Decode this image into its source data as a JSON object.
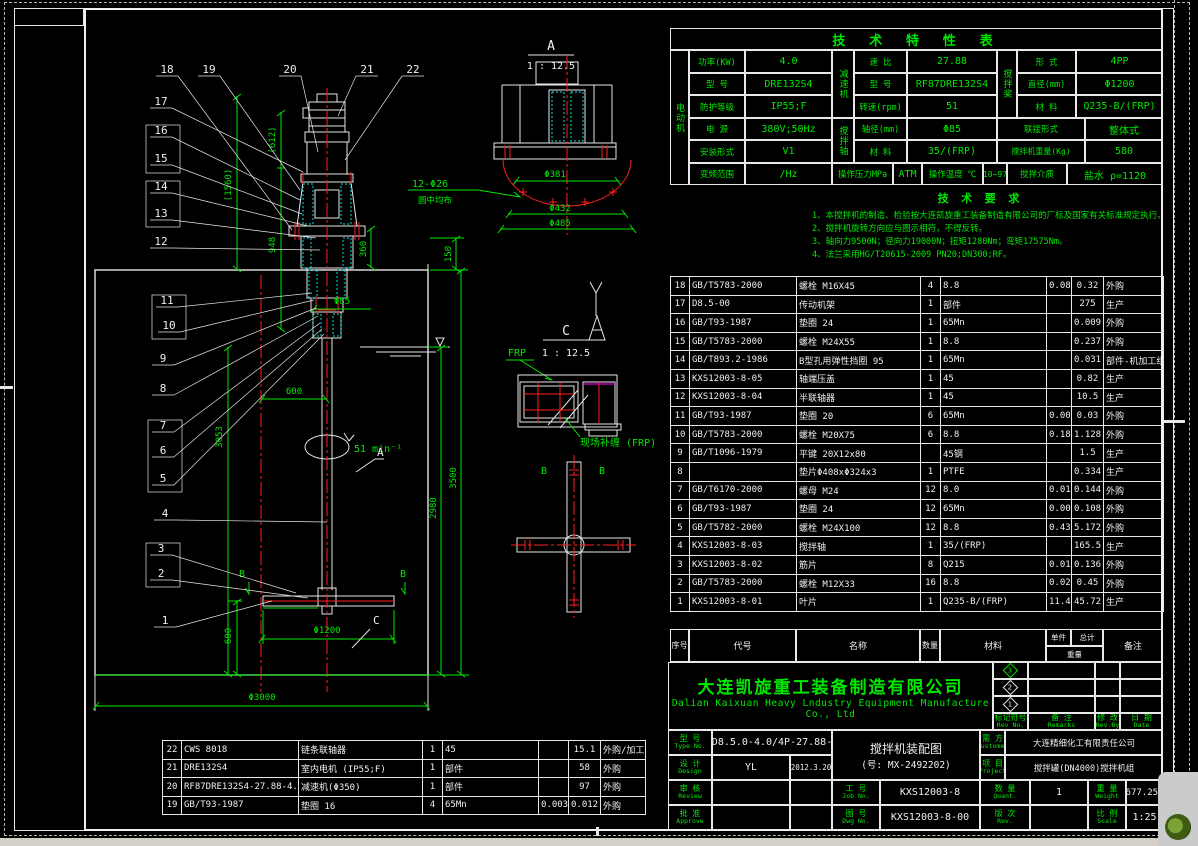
{
  "colors": {
    "green": "#00e800",
    "white": "#f0f0f0",
    "red": "#ff2020",
    "cyan": "#00e0e0",
    "magenta": "#ff00ff"
  },
  "spec_table": {
    "title": "技 术 特 性 表",
    "g_motor": "电动机",
    "g_reducer": "减速机",
    "g_shaft": "搅拌轴",
    "g_impeller": "搅拌桨",
    "r1": [
      "功率(KW)",
      "4.0",
      "速 比",
      "27.88",
      "形 式",
      "4PP"
    ],
    "r2": [
      "型 号",
      "DRE132S4",
      "型 号",
      "RF87DRE132S4",
      "直径(mm)",
      "Φ1200"
    ],
    "r3": [
      "防护等级",
      "IP55;F",
      "转速(rpm)",
      "51",
      "材 料",
      "Q235-B/(FRP)"
    ],
    "r4": [
      "电 源",
      "380V;50Hz",
      "轴径(mm)",
      "Φ85",
      "联接形式",
      "整体式"
    ],
    "r5": [
      "安装形式",
      "V1",
      "材 料",
      "35/(FRP)",
      "搅拌机重量(Kg)",
      "580"
    ],
    "r6": [
      "变频范围",
      "/Hz",
      "操作压力MPa",
      "ATM",
      "操作温度 ℃",
      "10~97",
      "搅拌介质",
      "盐水 ρ=1120"
    ]
  },
  "tech_req": {
    "title": "技 术 要 求",
    "lines": [
      "1、本搅拌机的制造、检验按大连凯旋重工装备制造有限公司的厂标及国家有关标准规定执行。",
      "2、搅拌机旋转方向应与图示相符，不得反转。",
      "3、轴向力9500N；径向力19000N；扭矩1280Nm；弯矩17575Nm。",
      "4、法兰采用HG/T20615-2009 PN20;DN300;RF。"
    ]
  },
  "bom": {
    "headers": {
      "no": "序号",
      "code": "代号",
      "name": "名称",
      "qty": "数量",
      "material": "材料",
      "unit": "单件",
      "total": "总计",
      "weight": "重量",
      "remark": "备注"
    },
    "rows": [
      [
        "18",
        "GB/T5783-2000",
        "螺栓 M16X45",
        "4",
        "8.8",
        "0.08",
        "0.32",
        "外购"
      ],
      [
        "17",
        "D8.5-00",
        "传动机架",
        "1",
        "部件",
        "",
        "275",
        "生产"
      ],
      [
        "16",
        "GB/T93-1987",
        "垫圈 24",
        "1",
        "65Mn",
        "",
        "0.009",
        "外购"
      ],
      [
        "15",
        "GB/T5783-2000",
        "螺栓 M24X55",
        "1",
        "8.8",
        "",
        "0.237",
        "外购"
      ],
      [
        "14",
        "GB/T893.2-1986",
        "B型孔用弹性挡圈 95",
        "1",
        "65Mn",
        "",
        "0.031",
        "部件-机加工组装"
      ],
      [
        "13",
        "KXS12003-8-05",
        "轴端压盖",
        "1",
        "45",
        "",
        "0.82",
        "生产"
      ],
      [
        "12",
        "KXS12003-8-04",
        "半联轴器",
        "1",
        "45",
        "",
        "10.5",
        "生产"
      ],
      [
        "11",
        "GB/T93-1987",
        "垫圈 20",
        "6",
        "65Mn",
        "0.005",
        "0.03",
        "外购"
      ],
      [
        "10",
        "GB/T5783-2000",
        "螺栓 M20X75",
        "6",
        "8.8",
        "0.188",
        "1.128",
        "外购"
      ],
      [
        "9",
        "GB/T1096-1979",
        "平键 20X12x80",
        "",
        "45钢",
        "",
        "1.5",
        "生产"
      ],
      [
        "8",
        "",
        "垫片Φ408xΦ324x3",
        "1",
        "PTFE",
        "",
        "0.334",
        "生产"
      ],
      [
        "7",
        "GB/T6170-2000",
        "螺母 M24",
        "12",
        "8.0",
        "0.012",
        "0.144",
        "外购"
      ],
      [
        "6",
        "GB/T93-1987",
        "垫圈 24",
        "12",
        "65Mn",
        "0.009",
        "0.108",
        "外购"
      ],
      [
        "5",
        "GB/T5782-2000",
        "螺栓 M24X100",
        "12",
        "8.8",
        "0.431",
        "5.172",
        "外购"
      ],
      [
        "4",
        "KXS12003-8-03",
        "搅拌轴",
        "1",
        "35/(FRP)",
        "",
        "165.5",
        "生产"
      ],
      [
        "3",
        "KXS12003-8-02",
        "筋片",
        "8",
        "Q215",
        "0.017",
        "0.136",
        "外购"
      ],
      [
        "2",
        "GB/T5783-2000",
        "螺栓 M12X33",
        "16",
        "8.8",
        "0.028",
        "0.45",
        "外购"
      ],
      [
        "1",
        "KXS12003-8-01",
        "叶片",
        "1",
        "Q235-B/(FRP)",
        "11.43",
        "45.72",
        "生产"
      ]
    ]
  },
  "left_table": {
    "rows": [
      [
        "22",
        "CWS 8018",
        "链条联轴器",
        "1",
        "45",
        "",
        "15.1",
        "外购/加工"
      ],
      [
        "21",
        "DRE132S4",
        "室内电机 (IP55;F)",
        "1",
        "部件",
        "",
        "58",
        "外购"
      ],
      [
        "20",
        "RF87DRE132S4-27.88-4.0Kw",
        "减速机(Φ350)",
        "1",
        "部件",
        "",
        "97",
        "外购"
      ],
      [
        "19",
        "GB/T93-1987",
        "垫圈 16",
        "4",
        "65Mn",
        "0.003",
        "0.012",
        "外购"
      ]
    ]
  },
  "title_block": {
    "company_cn": "大连凯旋重工装备制造有限公司",
    "company_en1": "Dalian Kaixuan Heavy Lndustry Equipment Manufacture",
    "company_en2": "Co., Ltd",
    "diamonds": [
      "3",
      "2",
      "1"
    ],
    "rev_no_cn": "标记符号",
    "rev_no_en": "Rev No.",
    "remarks_cn": "备 注",
    "remarks_en": "Remarks",
    "revby_cn": "修 改",
    "revby_en": "Rev.By",
    "date_cn": "日 期",
    "date_en": "Date",
    "type_cn": "型 号",
    "type_en": "Type No.",
    "type_value": "AD8.5.0-4.0/4P-27.88-P",
    "design_cn": "设 计",
    "design_en": "Design",
    "design_value": "YL",
    "design_date": "2012.3.20",
    "review_cn": "审 核",
    "review_en": "Review",
    "approve_cn": "批 准",
    "approve_en": "Approve",
    "name_line1": "搅拌机装配图",
    "name_line2": "(号: MX-2492202)",
    "customer_cn": "需 方",
    "customer_en": "Customer",
    "customer_value": "大连精细化工有限责任公司",
    "project_cn": "项 目",
    "project_en": "Project",
    "project_value": "搅拌罐(DN4000)搅拌机组",
    "job_cn": "工 号",
    "job_en": "Job No.",
    "job_value": "KXS12003-8",
    "dwg_cn": "图 号",
    "dwg_en": "Dwg No.",
    "dwg_value": "KXS12003-8-00",
    "quant_cn": "数 量",
    "quant_en": "Quant.",
    "quant_value": "1",
    "weight_cn": "重 量",
    "weight_en": "Weight",
    "weight_value": "677.250",
    "rev_cn": "版 次",
    "rev_en": "Rev.",
    "rev_value": "",
    "scale_cn": "比 例",
    "scale_en": "Scale",
    "scale_value": "1:25"
  },
  "drawing": {
    "balloons": {
      "b1": "1",
      "b2": "2",
      "b3": "3",
      "b4": "4",
      "b5": "5",
      "b6": "6",
      "b7": "7",
      "b8": "8",
      "b9": "9",
      "b10": "10",
      "b11": "11",
      "b12": "12",
      "b13": "13",
      "b14": "14",
      "b15": "15",
      "b16": "16",
      "b17": "17",
      "b18": "18",
      "b19": "19",
      "b20": "20",
      "b21": "21",
      "b22": "22"
    },
    "dims": {
      "d612": "(612)",
      "d1560": "(1560)",
      "d948": "948",
      "d360": "360",
      "d150": "150",
      "d85": "Φ85",
      "d600h": "600",
      "d3053": "3053",
      "rpm": "51 min⁻¹",
      "d2980": "2980",
      "d3500": "3500",
      "d600v": "600",
      "d1200": "Φ1200",
      "d3000": "Φ3000"
    },
    "detail_a": {
      "title": "A",
      "scale": "1 : 12.5",
      "holes": "12-Φ26",
      "holes_note": "圆中均布",
      "d381": "Φ381",
      "d432": "Φ432",
      "d485": "Φ485"
    },
    "detail_c": {
      "title": "C",
      "scale": "1 : 12.5",
      "frp": "FRP",
      "site_note": "现场补缠 (FRP)"
    },
    "section_a": "A",
    "section_b": "B",
    "section_c": "C"
  }
}
